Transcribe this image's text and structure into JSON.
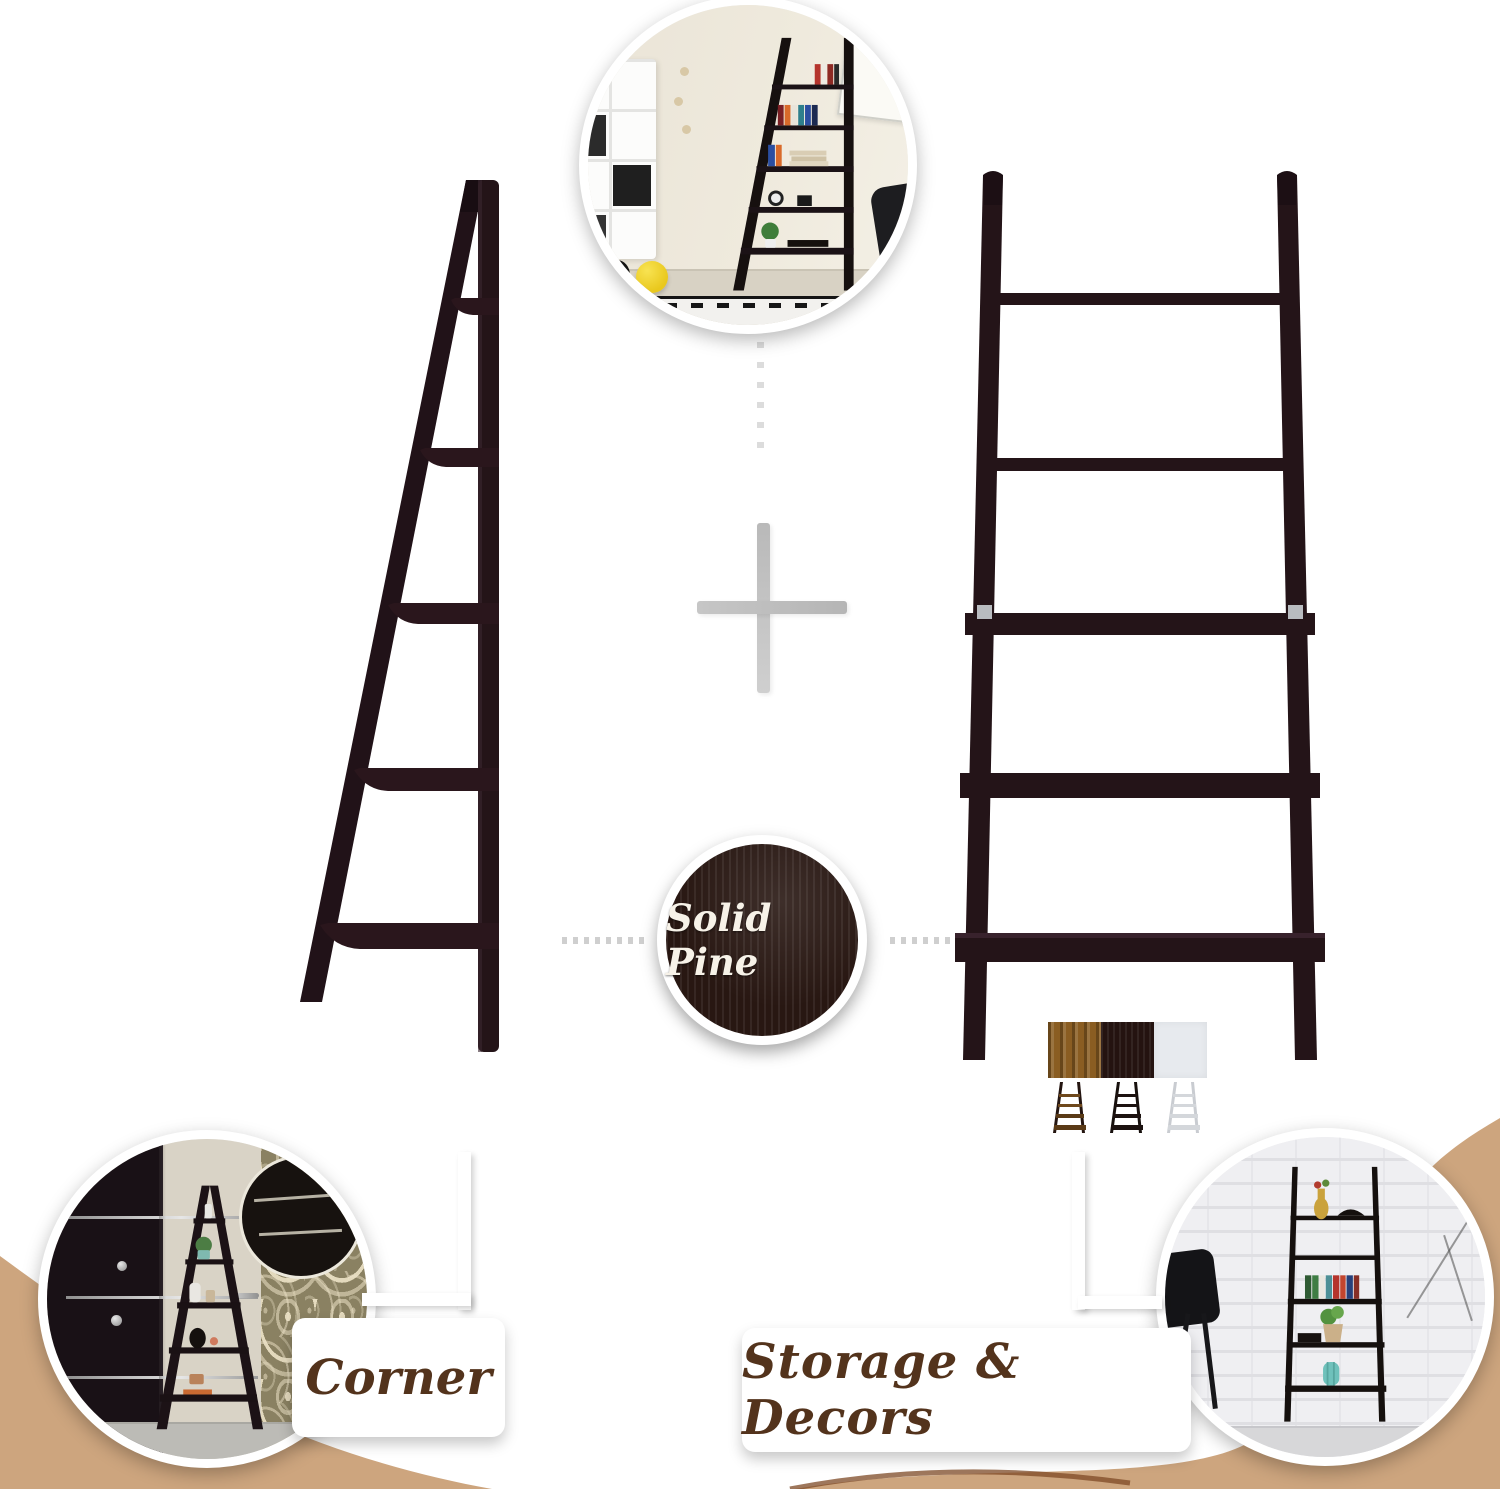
{
  "badge": {
    "label": "Solid Pine",
    "bg": "#281712",
    "text_color": "#f7f2e8"
  },
  "callouts": {
    "left": "Corner",
    "right": "Storage & Decors",
    "text_color": "#53331c"
  },
  "products": {
    "left": "5-tier corner ladder shelf",
    "right": "5-tier ladder bookshelf"
  },
  "swatches": [
    {
      "name": "walnut",
      "hex": "#8a5d22"
    },
    {
      "name": "espresso",
      "hex": "#241310"
    },
    {
      "name": "white",
      "hex": "#e7eaee"
    }
  ],
  "colors": {
    "ribbon_tan": "#cda57e",
    "ribbon_edge": "#7d4a26",
    "espresso_wood": "#241418",
    "accent_teal": "#6fc1bb",
    "ball_yellow": "#eecb1f"
  }
}
